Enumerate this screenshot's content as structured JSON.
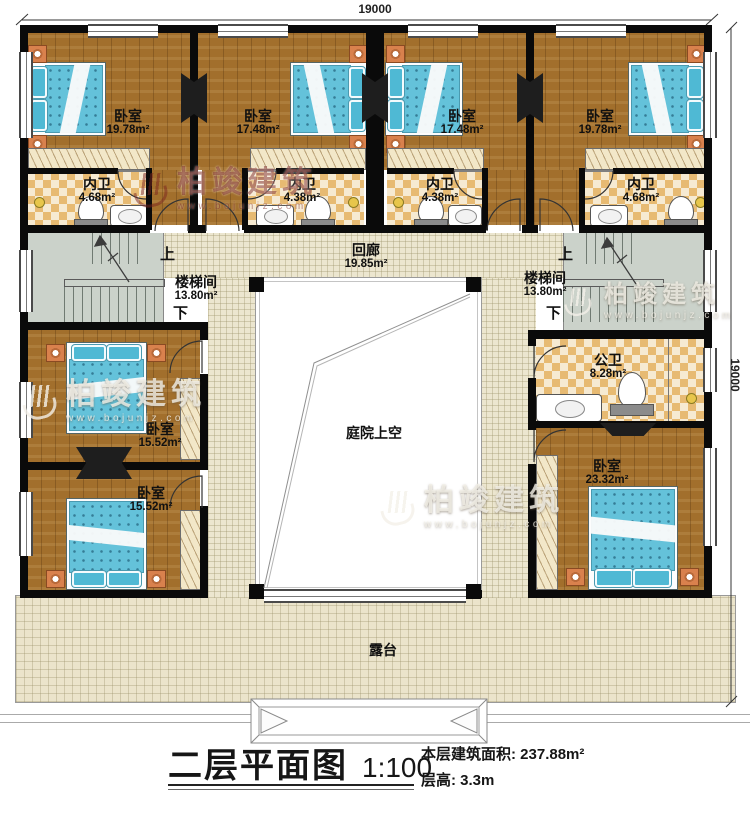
{
  "dimensions": {
    "top": "19000",
    "right": "19000"
  },
  "stairs": {
    "up": "上",
    "down": "下"
  },
  "rooms": {
    "bedroom_top_1": {
      "name": "卧室",
      "area": "19.78m²"
    },
    "bedroom_top_2": {
      "name": "卧室",
      "area": "17.48m²"
    },
    "bedroom_top_3": {
      "name": "卧室",
      "area": "17.48m²"
    },
    "bedroom_top_4": {
      "name": "卧室",
      "area": "19.78m²"
    },
    "ensuite_1": {
      "name": "内卫",
      "area": "4.68m²"
    },
    "ensuite_2": {
      "name": "内卫",
      "area": "4.38m²"
    },
    "ensuite_3": {
      "name": "内卫",
      "area": "4.38m²"
    },
    "ensuite_4": {
      "name": "内卫",
      "area": "4.68m²"
    },
    "corridor": {
      "name": "回廊",
      "area": "19.85m²"
    },
    "stair_left": {
      "name": "楼梯间",
      "area": "13.80m²"
    },
    "stair_right": {
      "name": "楼梯间",
      "area": "13.80m²"
    },
    "bedroom_left_1": {
      "name": "卧室",
      "area": "15.52m²"
    },
    "bedroom_left_2": {
      "name": "卧室",
      "area": "15.52m²"
    },
    "public_bath": {
      "name": "公卫",
      "area": "8.28m²"
    },
    "bedroom_right": {
      "name": "卧室",
      "area": "23.32m²"
    },
    "courtyard": {
      "name": "庭院上空"
    },
    "terrace": {
      "name": "露台"
    }
  },
  "titleblock": {
    "title": "二层平面图",
    "scale": "1:100",
    "area_label": "本层建筑面积:",
    "area_value": "237.88m²",
    "height_label": "层高:",
    "height_value": "3.3m"
  },
  "watermark": {
    "brand": "柏竣建筑",
    "site": "www.bojunjz.com"
  },
  "colors": {
    "wood_floor": "#a26f2c",
    "tile_dark": "#e7ba72",
    "tile_light": "#f6ead2",
    "corridor_floor": "#ece6cf",
    "stair_floor": "#cbd2ca",
    "bed_blue": "#64c2da",
    "wall": "#0a0a0a"
  }
}
